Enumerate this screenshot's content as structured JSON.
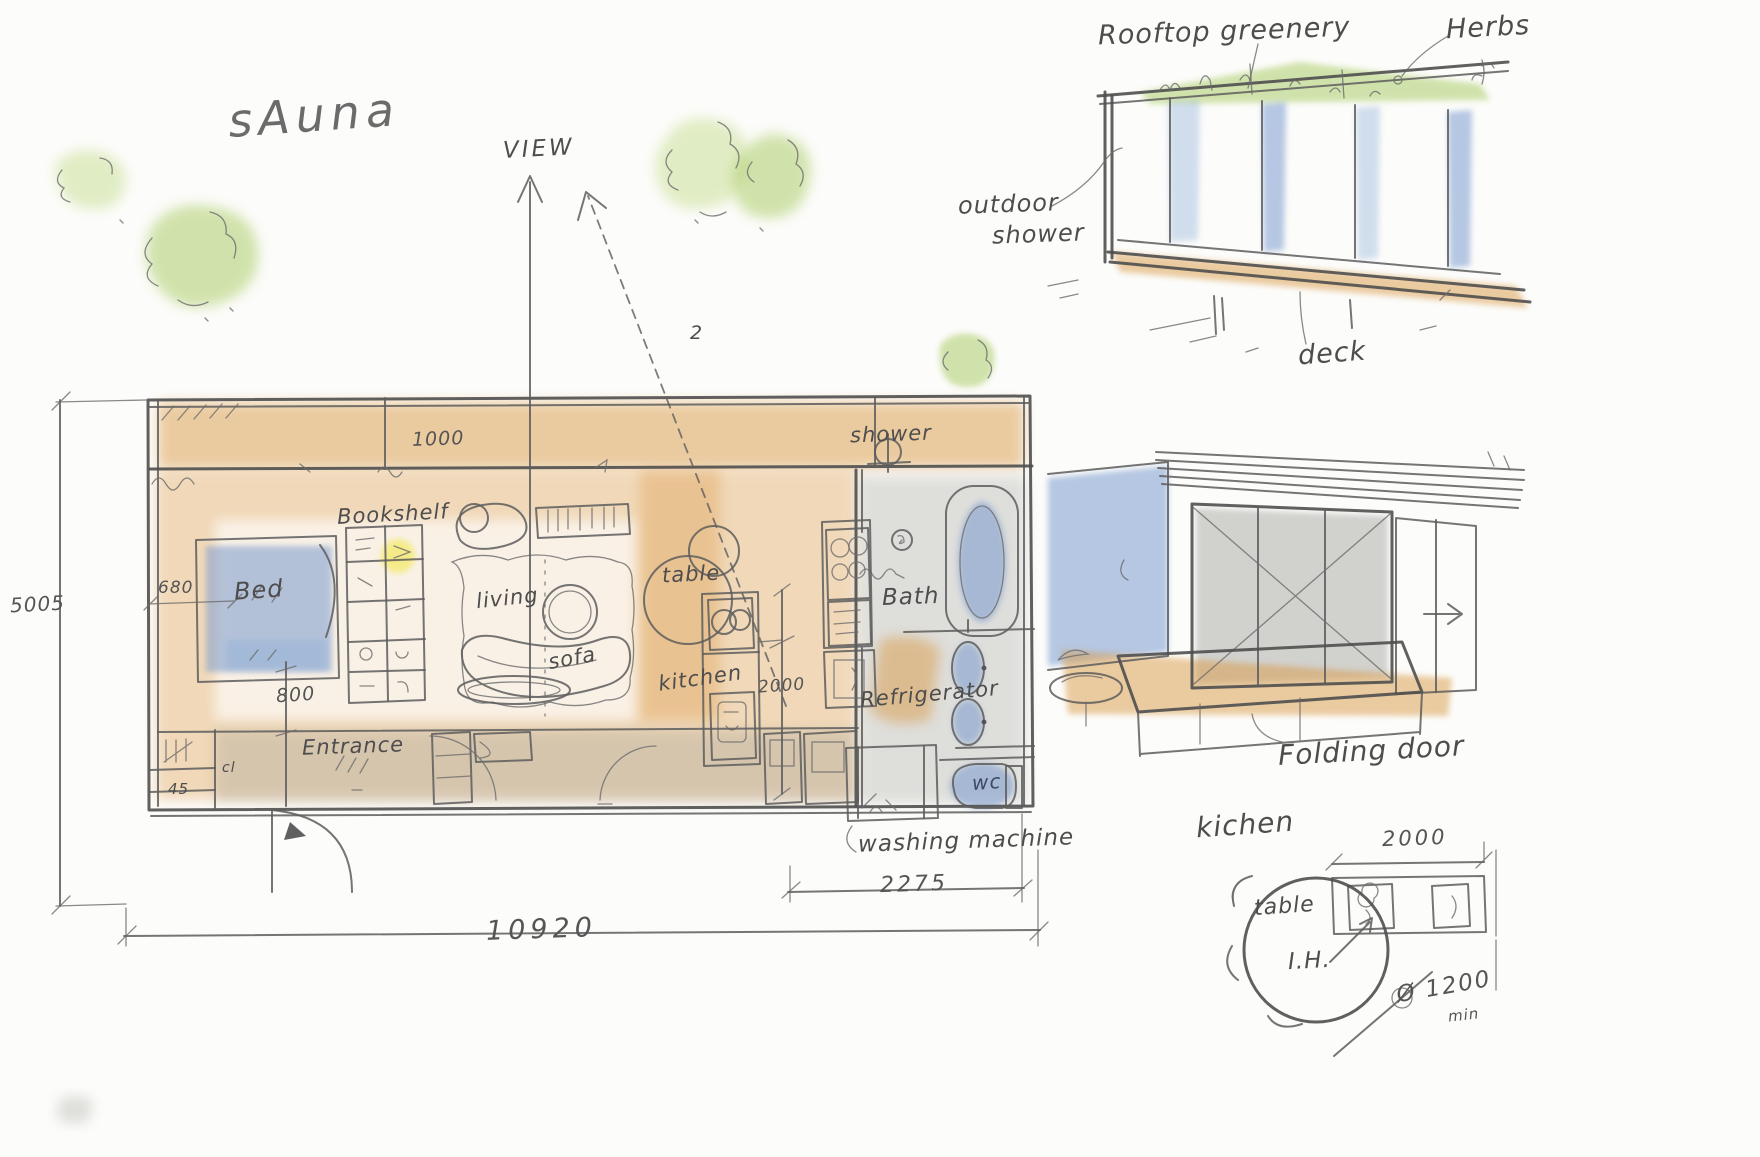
{
  "title": "sAuna",
  "site": {
    "view_label": "VIEW",
    "view_number": "2"
  },
  "building_sketch": {
    "rooftop": "Rooftop greenery",
    "herbs": "Herbs",
    "outdoor_shower_line1": "outdoor",
    "outdoor_shower_line2": "shower",
    "deck": "deck"
  },
  "floorplan": {
    "rooms": {
      "bed": "Bed",
      "bookshelf": "Bookshelf",
      "living": "living",
      "sofa": "sofa",
      "table": "table",
      "kitchen": "kitchen",
      "shower": "shower",
      "bath": "Bath",
      "refrigerator": "Refrigerator",
      "wc": "wc",
      "washing_machine": "washing machine",
      "entrance": "Entrance",
      "closet": "cl",
      "corner": "45"
    },
    "dimensions": {
      "top": "1000",
      "left": "5005",
      "bed_side": "680",
      "bed_bottom": "800",
      "kitchen": "2000",
      "bath": "2275",
      "total": "10920"
    }
  },
  "interior_sketch": {
    "folding_door": "Folding door"
  },
  "kitchen_detail": {
    "label": "kichen",
    "dimension": "2000",
    "table": "table",
    "ih": "I.H.",
    "diameter": "Ø 1200",
    "min": "min"
  },
  "colors": {
    "pencil": "#5d5d5d",
    "floor_wash": "#e0a358",
    "water_wash": "#6f93cc",
    "green_wash": "#9cc44e",
    "gray_wash": "#9c9c96"
  }
}
